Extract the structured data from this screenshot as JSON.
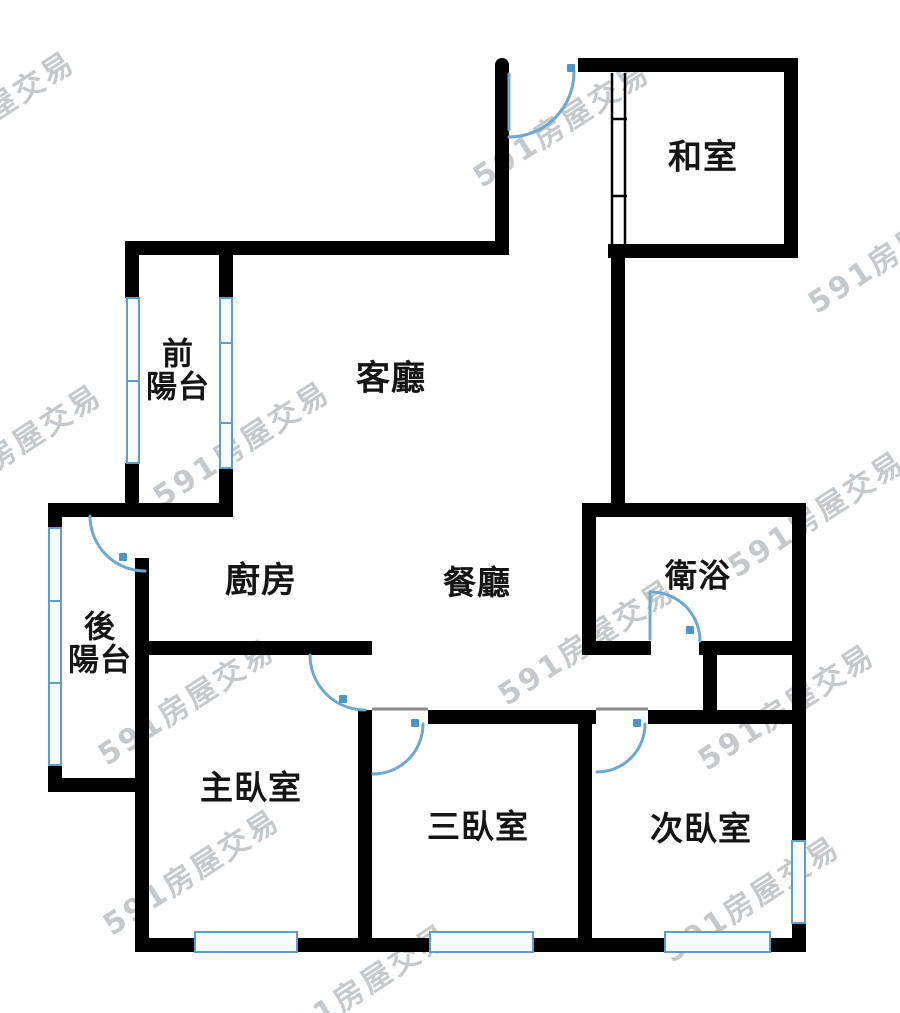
{
  "meta": {
    "width": 900,
    "height": 1013,
    "background": "#ffffff"
  },
  "colors": {
    "wall": "#000000",
    "door_arc": "#6fa8cd",
    "door_marker": "#4e96c5",
    "window_border": "#5f9ec7",
    "window_fill": "#f7fbfe",
    "header_line": "#8a8a8a",
    "label_text": "#151515",
    "watermark_text": "#969ca2"
  },
  "watermark": {
    "text": "591房屋交易",
    "rotation_deg": -33,
    "font_size": 30,
    "instances": [
      {
        "x": -15,
        "y": 112
      },
      {
        "x": 560,
        "y": 122
      },
      {
        "x": 895,
        "y": 248
      },
      {
        "x": 12,
        "y": 445
      },
      {
        "x": 240,
        "y": 442
      },
      {
        "x": 815,
        "y": 512
      },
      {
        "x": 585,
        "y": 640
      },
      {
        "x": 185,
        "y": 700
      },
      {
        "x": 785,
        "y": 705
      },
      {
        "x": 190,
        "y": 870
      },
      {
        "x": 750,
        "y": 897
      },
      {
        "x": 360,
        "y": 985
      }
    ]
  },
  "rooms": [
    {
      "id": "washitsu",
      "label": "和室",
      "x": 703,
      "y": 158,
      "size": 34
    },
    {
      "id": "living",
      "label": "客廳",
      "x": 391,
      "y": 379,
      "size": 34
    },
    {
      "id": "front-balcony",
      "label": "前\n陽台",
      "x": 178,
      "y": 372,
      "size": 31
    },
    {
      "id": "back-balcony",
      "label": "後\n陽台",
      "x": 100,
      "y": 645,
      "size": 31
    },
    {
      "id": "kitchen",
      "label": "廚房",
      "x": 261,
      "y": 582,
      "size": 35
    },
    {
      "id": "dining",
      "label": "餐廳",
      "x": 477,
      "y": 583,
      "size": 33
    },
    {
      "id": "bathroom",
      "label": "衛浴",
      "x": 698,
      "y": 576,
      "size": 32
    },
    {
      "id": "master-bedroom",
      "label": "主臥室",
      "x": 251,
      "y": 788,
      "size": 33
    },
    {
      "id": "third-bedroom",
      "label": "三臥室",
      "x": 478,
      "y": 827,
      "size": 33
    },
    {
      "id": "second-bedroom",
      "label": "次臥室",
      "x": 701,
      "y": 829,
      "size": 33
    }
  ],
  "walls": [
    {
      "name": "wall-entry-left",
      "rect": [
        495,
        58,
        14,
        197
      ],
      "radius": "7px 7px 0 0"
    },
    {
      "name": "wall-top",
      "rect": [
        578,
        58,
        220,
        14
      ]
    },
    {
      "name": "wall-washitsu-right",
      "rect": [
        784,
        58,
        14,
        200
      ],
      "radius": "0 8px 0 0"
    },
    {
      "name": "wall-washitsu-bottom",
      "rect": [
        608,
        244,
        190,
        14
      ]
    },
    {
      "name": "wall-core-vertical",
      "rect": [
        611,
        258,
        14,
        259
      ]
    },
    {
      "name": "wall-living-top",
      "rect": [
        125,
        241,
        384,
        14
      ]
    },
    {
      "name": "wall-front-balcony-left-upper",
      "rect": [
        125,
        241,
        14,
        57
      ]
    },
    {
      "name": "wall-front-balcony-left-lower",
      "rect": [
        125,
        463,
        14,
        54
      ]
    },
    {
      "name": "wall-front-balcony-right-upper",
      "rect": [
        219,
        255,
        14,
        43
      ]
    },
    {
      "name": "wall-front-balcony-right-lower",
      "rect": [
        219,
        467,
        14,
        50
      ]
    },
    {
      "name": "wall-balcony-divider",
      "rect": [
        48,
        503,
        185,
        14
      ]
    },
    {
      "name": "wall-back-balcony-left-upper",
      "rect": [
        48,
        503,
        14,
        25
      ],
      "radius": "6px 0 0 0"
    },
    {
      "name": "wall-back-balcony-left-lower",
      "rect": [
        48,
        765,
        14,
        27
      ]
    },
    {
      "name": "wall-back-balcony-bottom",
      "rect": [
        48,
        778,
        87,
        14
      ],
      "radius": "0 0 0 8px"
    },
    {
      "name": "wall-west",
      "rect": [
        135,
        558,
        14,
        394
      ]
    },
    {
      "name": "wall-kitchen-south",
      "rect": [
        149,
        641,
        223,
        14
      ]
    },
    {
      "name": "wall-master-east",
      "rect": [
        358,
        710,
        14,
        242
      ]
    },
    {
      "name": "wall-south",
      "rect": [
        135,
        938,
        671,
        14
      ]
    },
    {
      "name": "wall-bed3-north",
      "rect": [
        428,
        710,
        168,
        14
      ]
    },
    {
      "name": "wall-bed23-divider",
      "rect": [
        578,
        710,
        14,
        242
      ]
    },
    {
      "name": "wall-bed2-north",
      "rect": [
        648,
        710,
        158,
        14
      ]
    },
    {
      "name": "wall-east-upper",
      "rect": [
        792,
        503,
        14,
        339
      ]
    },
    {
      "name": "wall-east-lower",
      "rect": [
        792,
        923,
        14,
        29
      ],
      "radius": "0 0 8px 0"
    },
    {
      "name": "wall-bath-north",
      "rect": [
        582,
        503,
        224,
        14
      ]
    },
    {
      "name": "wall-bath-west",
      "rect": [
        582,
        503,
        14,
        152
      ]
    },
    {
      "name": "wall-bath-south-left",
      "rect": [
        582,
        641,
        69,
        14
      ]
    },
    {
      "name": "wall-bath-south-right",
      "rect": [
        699,
        641,
        107,
        14
      ]
    },
    {
      "name": "wall-shaft-stub",
      "rect": [
        703,
        655,
        14,
        57
      ]
    }
  ],
  "windows": [
    {
      "name": "window-front-balcony-left",
      "rect": [
        126,
        297,
        14,
        167
      ],
      "dividers": [
        380
      ]
    },
    {
      "name": "window-front-balcony-right",
      "rect": [
        219,
        297,
        14,
        172
      ],
      "dividers": [
        342,
        422
      ]
    },
    {
      "name": "window-back-balcony-left",
      "rect": [
        48,
        527,
        14,
        239
      ],
      "dividers": [
        600,
        682
      ]
    },
    {
      "name": "window-master-south",
      "rect": [
        194,
        931,
        104,
        22
      ],
      "dividers": []
    },
    {
      "name": "window-bed3-south",
      "rect": [
        429,
        931,
        105,
        22
      ],
      "dividers": []
    },
    {
      "name": "window-bed2-south",
      "rect": [
        664,
        931,
        107,
        22
      ],
      "dividers": []
    },
    {
      "name": "window-bed2-east",
      "rect": [
        791,
        840,
        15,
        84
      ],
      "dividers": []
    }
  ],
  "doors": [
    {
      "name": "entry-door",
      "path": "M 509 137 A 65 65 0 0 0 574 72",
      "leaf": [
        509,
        74,
        509,
        130
      ],
      "marker": [
        567,
        64
      ]
    },
    {
      "name": "back-balcony-door",
      "path": "M 90 516 A 55 55 0 0 0 145 571",
      "marker": [
        119,
        553
      ]
    },
    {
      "name": "master-door",
      "path": "M 310 655 A 55 55 0 0 0 365 710",
      "marker": [
        339,
        695
      ]
    },
    {
      "name": "bathroom-door",
      "path": "M 651 592 A 49 49 0 0 1 700 641",
      "leaf": [
        650,
        592,
        650,
        639
      ],
      "marker": [
        686,
        626
      ]
    },
    {
      "name": "bed3-door",
      "path": "M 423 724 A 50 50 0 0 1 373 774",
      "marker": [
        411,
        719
      ]
    },
    {
      "name": "bed2-door",
      "path": "M 645 724 A 48 48 0 0 1 597 772",
      "marker": [
        633,
        719
      ]
    }
  ],
  "sliding_door": {
    "name": "washitsu-sliding-door",
    "lines": [
      [
        612,
        73,
        612,
        244
      ],
      [
        625,
        73,
        625,
        244
      ]
    ],
    "ticks": [
      [
        611,
        119,
        627,
        119
      ],
      [
        611,
        196,
        627,
        196
      ]
    ]
  },
  "header_lines": [
    [
      372,
      709,
      428,
      709
    ],
    [
      596,
      709,
      648,
      709
    ]
  ]
}
